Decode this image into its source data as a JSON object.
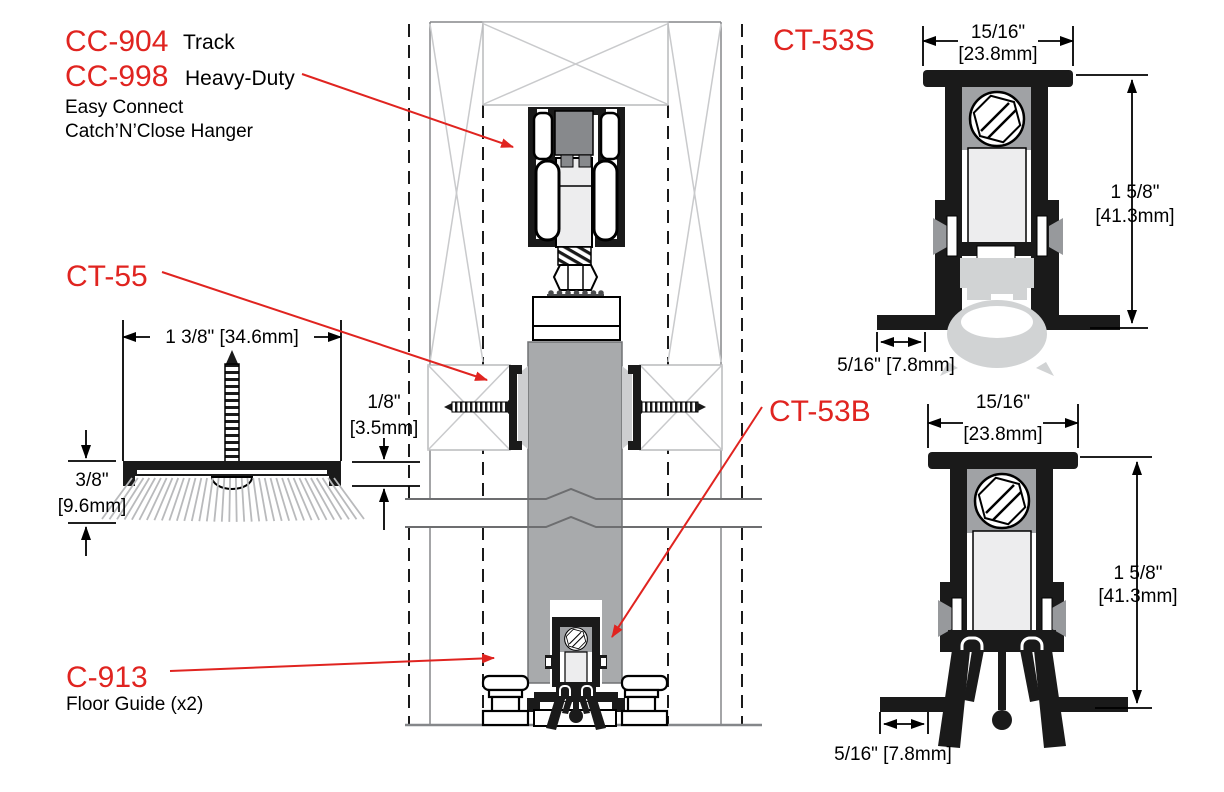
{
  "title": "Sliding door hardware section diagram",
  "labels": {
    "cc904": {
      "part": "CC-904",
      "desc": "Track"
    },
    "cc998": {
      "part": "CC-998",
      "desc": "Heavy-Duty",
      "line2": "Easy Connect",
      "line3": "Catch’N’Close Hanger"
    },
    "ct55": {
      "part": "CT-55"
    },
    "c913": {
      "part": "C-913",
      "desc": "Floor Guide (x2)"
    },
    "ct53s": {
      "part": "CT-53S"
    },
    "ct53b": {
      "part": "CT-53B"
    }
  },
  "dims": {
    "ct55": {
      "width": "1 3/8\" [34.6mm]",
      "h_left_in": "3/8\"",
      "h_left_mm": "[9.6mm]",
      "h_right_in": "1/8\"",
      "h_right_mm": "[3.5mm]"
    },
    "ct53s": {
      "width_in": "15/16\"",
      "width_mm": "[23.8mm]",
      "height_in": "1 5/8\"",
      "height_mm": "[41.3mm]",
      "flange": "5/16\" [7.8mm]"
    },
    "ct53b": {
      "width_in": "15/16\"",
      "width_mm": "[23.8mm]",
      "height_in": "1 5/8\"",
      "height_mm": "[41.3mm]",
      "flange": "5/16\" [7.8mm]"
    }
  },
  "colors": {
    "accent_red": "#e02420",
    "door_gray": "#a8aaac",
    "light_gray": "#d1d3d4",
    "mid_gray": "#97999c",
    "trolley_gray": "#87898c",
    "brace_gray": "#c9cacc",
    "bristle_gray": "#b9babc",
    "line_gray": "#85878a",
    "black": "#1a1a1a"
  }
}
